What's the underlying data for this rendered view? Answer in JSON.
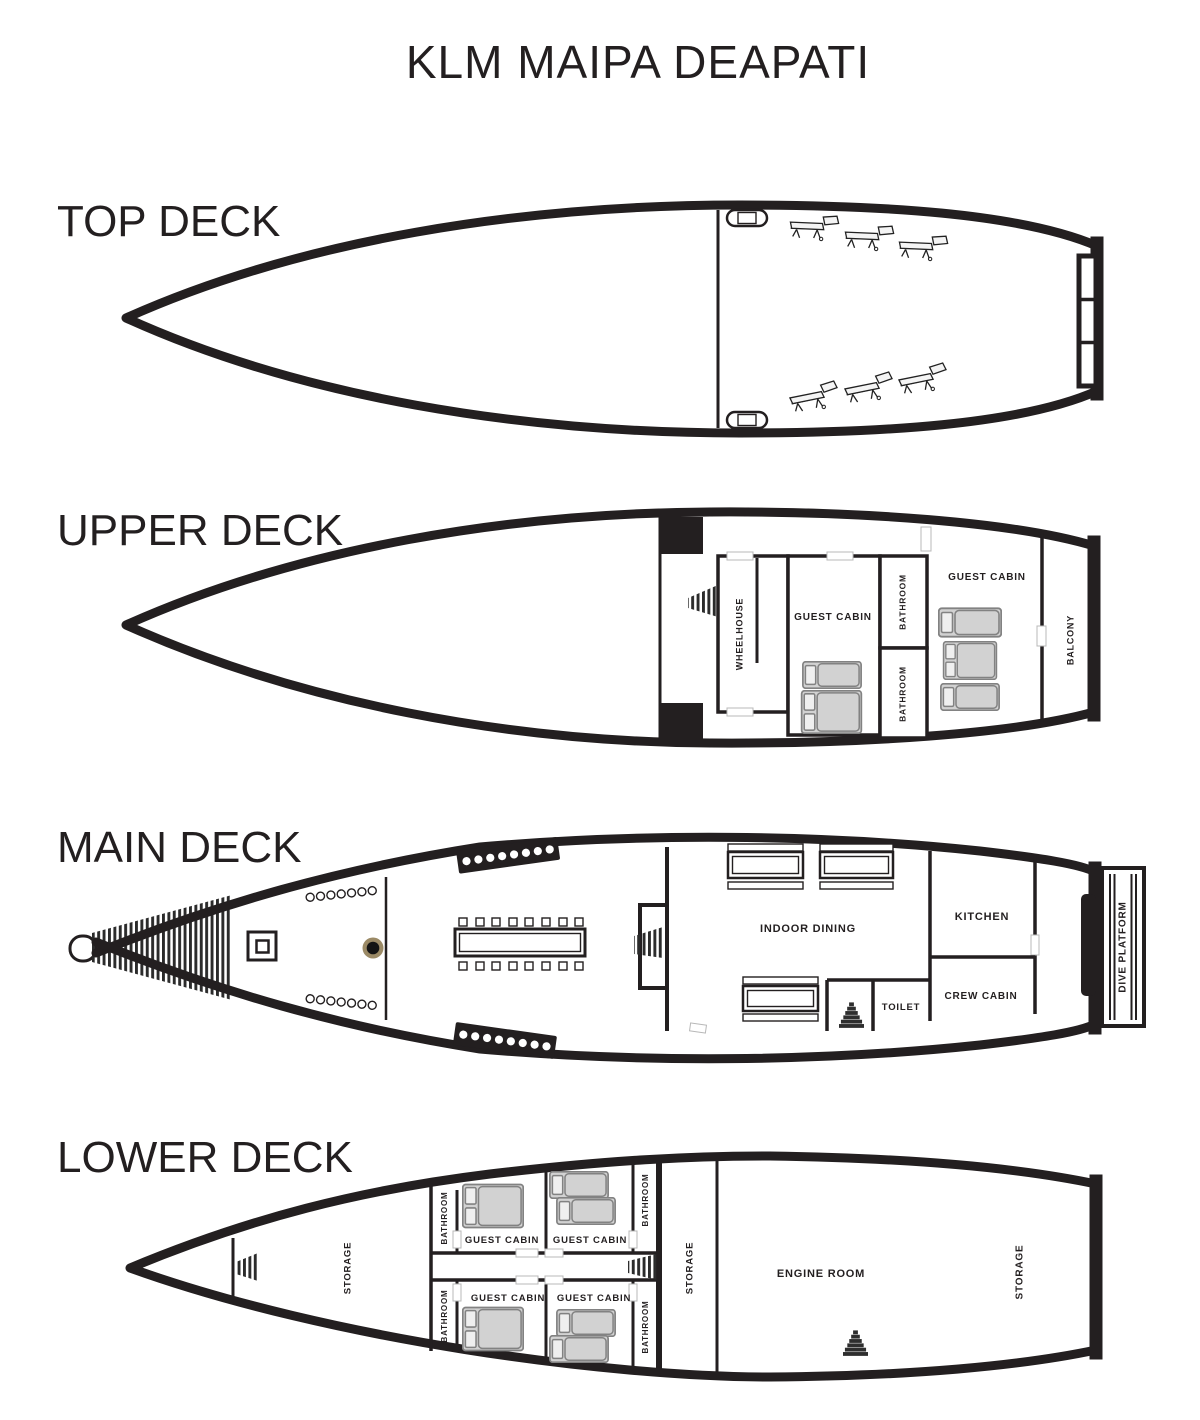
{
  "title": "KLM MAIPA DEAPATI",
  "decks": {
    "top": {
      "label": "TOP DECK"
    },
    "upper": {
      "label": "UPPER DECK",
      "rooms": {
        "wheelhouse": "WHEELHOUSE",
        "guest_cabin_fwd": "GUEST CABIN",
        "bathroom_fwd": "BATHROOM",
        "bathroom_aft": "BATHROOM",
        "guest_cabin_aft": "GUEST CABIN",
        "balcony": "BALCONY"
      }
    },
    "main": {
      "label": "MAIN DECK",
      "rooms": {
        "indoor_dining": "INDOOR DINING",
        "toilet": "TOILET",
        "kitchen": "KITCHEN",
        "crew_cabin": "CREW CABIN",
        "dive_platform": "DIVE PLATFORM"
      }
    },
    "lower": {
      "label": "LOWER DECK",
      "rooms": {
        "storage_bow": "STORAGE",
        "bathroom_1": "BATHROOM",
        "guest_cabin_1": "GUEST CABIN",
        "guest_cabin_2": "GUEST CABIN",
        "bathroom_2": "BATHROOM",
        "bathroom_3": "BATHROOM",
        "guest_cabin_3": "GUEST CABIN",
        "guest_cabin_4": "GUEST CABIN",
        "bathroom_4": "BATHROOM",
        "storage_mid": "STORAGE",
        "engine_room": "ENGINE ROOM",
        "storage_stern": "STORAGE"
      }
    }
  },
  "colors": {
    "line": "#231f20",
    "bed_fill": "#d2d2d2",
    "mast_ring": "#9b8a66"
  }
}
